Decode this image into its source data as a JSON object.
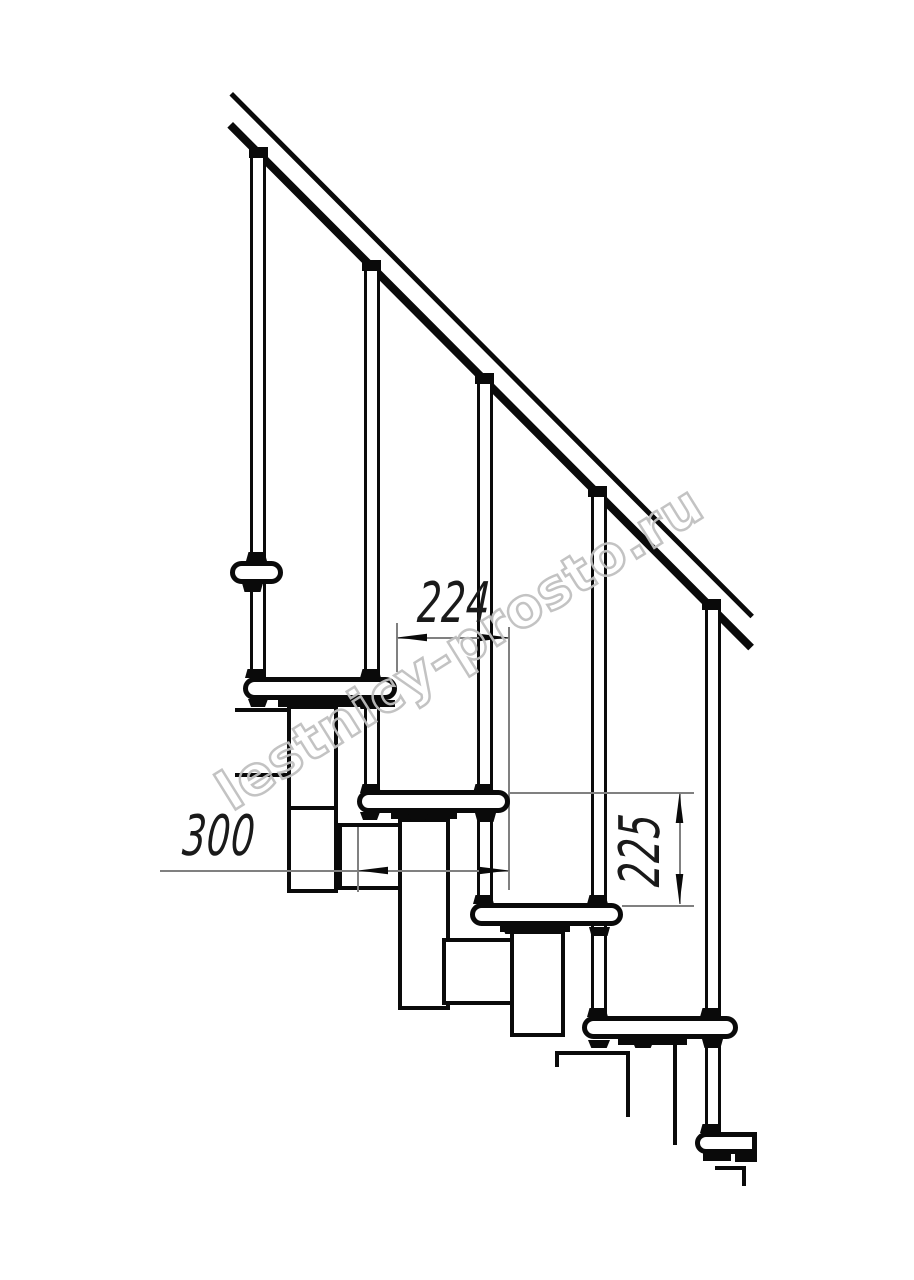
{
  "page": {
    "width": 914,
    "height": 1280,
    "background": "#ffffff"
  },
  "drawing": {
    "watermark": {
      "text": "lestnicy-prosto.ru",
      "color": "#c0c0c0",
      "angle_deg": -32
    },
    "dimensions": [
      {
        "label": "224",
        "orientation": "horizontal"
      },
      {
        "label": "300",
        "orientation": "horizontal"
      },
      {
        "label": "225",
        "orientation": "vertical"
      }
    ],
    "colors": {
      "line": "#0a0a0a",
      "dim_line": "#808080",
      "dim_text": "#1a1a1a"
    }
  }
}
